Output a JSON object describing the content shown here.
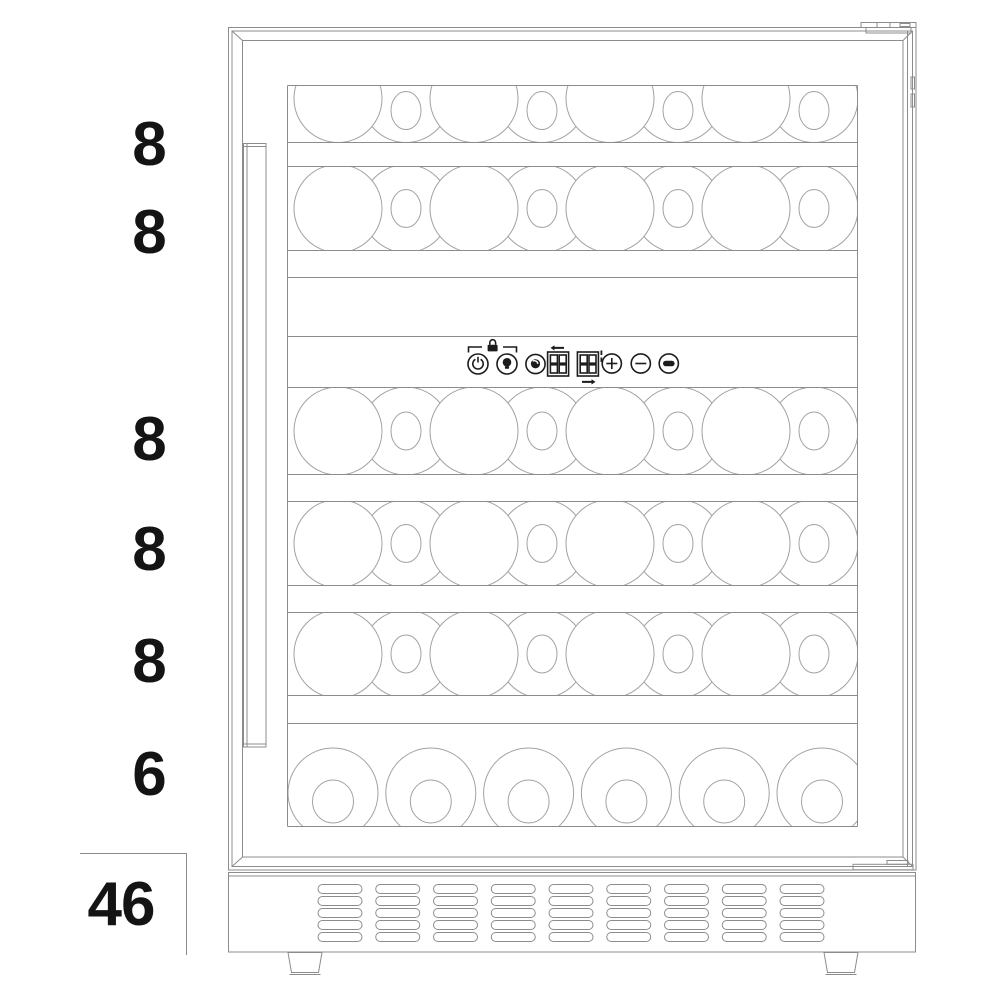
{
  "diagram": {
    "name": "wine-cooler-bottle-capacity-front-view",
    "shelf_rows": [
      {
        "label": "8",
        "bottles": 8,
        "view": "side"
      },
      {
        "label": "8",
        "bottles": 8,
        "view": "side"
      },
      {
        "label": "8",
        "bottles": 8,
        "view": "side"
      },
      {
        "label": "8",
        "bottles": 8,
        "view": "side"
      },
      {
        "label": "8",
        "bottles": 8,
        "view": "side"
      },
      {
        "label": "6",
        "bottles": 6,
        "view": "bottom"
      }
    ],
    "total": {
      "label": "46",
      "value": 46
    }
  },
  "control_panel": {
    "icons": [
      {
        "name": "power-button"
      },
      {
        "name": "light-bulb-button"
      },
      {
        "name": "lock-indicator"
      },
      {
        "name": "temperature-sensor-button"
      },
      {
        "name": "upper-zone-display"
      },
      {
        "name": "lower-zone-display"
      },
      {
        "name": "increase-button"
      },
      {
        "name": "decrease-button"
      },
      {
        "name": "interior-light-button"
      }
    ]
  },
  "colors": {
    "line": "#8c8c8c",
    "circle": "#a2a2a2",
    "icon": "#1c1c1c",
    "text": "#141414",
    "background": "#ffffff"
  }
}
